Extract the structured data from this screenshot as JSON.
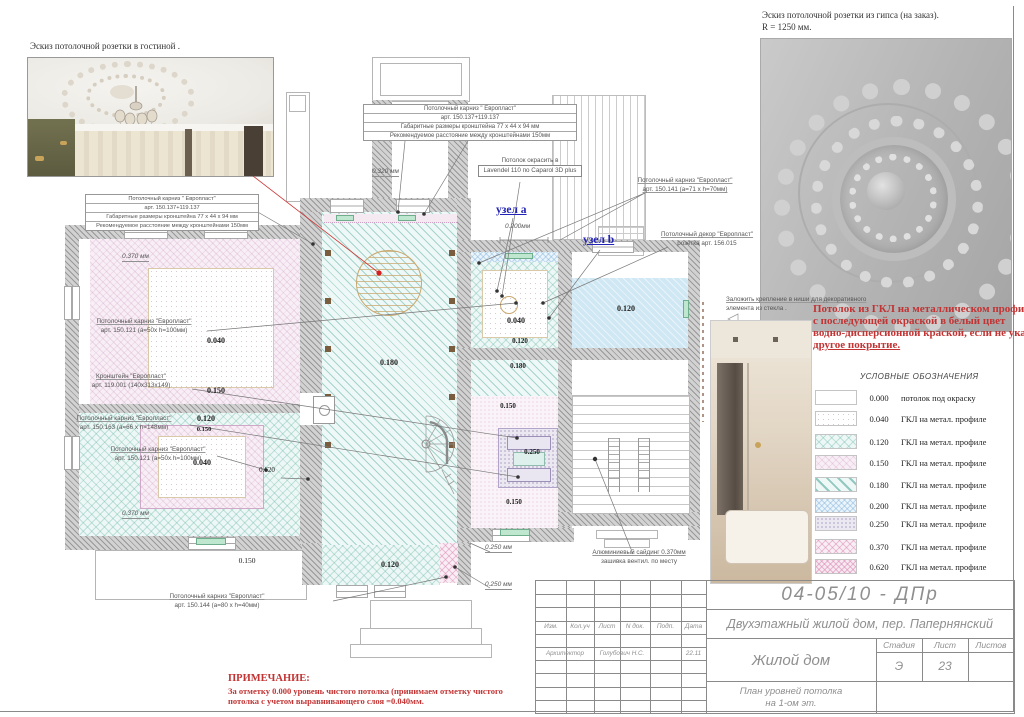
{
  "captions": {
    "living": "Эскиз потолочной розетки в гостиной .",
    "plaster1": "Эскиз потолочной розетки из гипса  (на заказ).",
    "plaster2": "R = 1250 мм."
  },
  "box": {
    "l1": "Потолочный карниз \" Европласт\"",
    "l2": "арт. 150.137+119.137",
    "l3": "Габаритные размеры кронштейна 77 х 44 х 94 мм",
    "l4": "Рекомендуемое расстояние между кронштейнами 150мм"
  },
  "paint": {
    "l1": "Потолок окрасить в",
    "l2": "Lavendel 110 по Caparol 3D plus"
  },
  "co": {
    "c141": {
      "l1": "Потолочный карниз \"Европласт\"",
      "l2": "арт. 150.141 (а=71 х h=70мм)"
    },
    "r156": {
      "l1": "Потолочный декор \"Европласт\"",
      "l2": "розетка арт. 156.015"
    },
    "c121a": {
      "l1": "Потолочный карниз \"Европласт\"",
      "l2": "арт. 150.121 (а=50х h=100мм)"
    },
    "b119": {
      "l1": "Кронштейн \"Европласт\"",
      "l2": "арт. 119.001 (140х313х149)"
    },
    "c163": {
      "l1": "Потолочный карниз \"Европласт\"",
      "l2": "арт. 150.163 (а=66 х h=148мм)"
    },
    "c121b": {
      "l1": "Потолочный карниз \"Европласт\"",
      "l2": "арт. 150.121 (а=50х h=100мм)"
    },
    "c144": {
      "l1": "Потолочный карниз \"Европласт\"",
      "l2": "арт. 150.144 (а=80 х h=40мм)"
    },
    "siding": {
      "l1": "Алюминиевый сайдинг 0.370мм",
      "l2": "зашивка вентил. по месту"
    },
    "glass": {
      "l1": "Заложить крепление в ниши для декоративного",
      "l2": "элемента из стекла ."
    },
    "node_a": "узел a",
    "node_b": "узел b"
  },
  "red": {
    "l1": "Потолок из ГКЛ на металлическом профиле",
    "l2": " с последующей окраской в белый цвет",
    "l3": "водно-дисперсионной краской, если не указано",
    "l4": "другое покрытие."
  },
  "lv": {
    "lt040": "0.040",
    "lt150": "0.150",
    "hall180": "0.180",
    "lb120": "0.120",
    "lb150": "0.150",
    "lb040": "0.040",
    "porch150": "0.150",
    "d620": "0.620",
    "rt040": "0.040",
    "rt120": "0.120",
    "fr120": "0.120",
    "band180": "0.180",
    "rb150a": "0.150",
    "rb250": "0.250",
    "rb150b": "0.150",
    "bc120": "0.120"
  },
  "dm": {
    "d320": "0.320 мм",
    "d200": "0.200мм",
    "d370a": "0.370 мм",
    "d370b": "0.370 мм",
    "d250a": "0.250 мм",
    "d250b": "0.250 мм"
  },
  "legend": {
    "title": "УСЛОВНЫЕ  ОБОЗНАЧЕНИЯ",
    "rows": [
      {
        "value": "0.000",
        "label": "потолок под окраску"
      },
      {
        "value": "0.040",
        "label": "ГКЛ на метал. профиле"
      },
      {
        "value": "0.120",
        "label": "ГКЛ на метал. профиле"
      },
      {
        "value": "0.150",
        "label": "ГКЛ на метал. профиле"
      },
      {
        "value": "0.180",
        "label": "ГКЛ на метал. профиле"
      },
      {
        "value": "0.200",
        "label": "ГКЛ на метал. профиле"
      },
      {
        "value": "0.250",
        "label": "ГКЛ на метал. профиле"
      },
      {
        "value": "0.370",
        "label": "ГКЛ на метал. профиле"
      },
      {
        "value": "0.620",
        "label": "ГКЛ на метал. профиле"
      }
    ]
  },
  "note": {
    "title": "ПРИМЕЧАНИЕ:",
    "l1": "За отметку 0.000 уровень чистого потолка (принимаем отметку  чистого",
    "l2": "потолка с учетом выравнивающего слоя  =0.040мм."
  },
  "tb": {
    "doc": "04-05/10 - ДПр",
    "project": "Двухэтажный жилой дом, пер. Папернянский",
    "object": "Жилой дом",
    "sheet1": "План  уровней потолка",
    "sheet2": "на 1-ом эт.",
    "h_izm": "Изм.",
    "h_koluch": "Кол.уч",
    "h_list": "Лист",
    "h_ndok": "N док.",
    "h_podp": "Подп.",
    "h_data": "Дата",
    "role": "Архитектор",
    "name": "Голубович Н.С.",
    "date": "22.11",
    "h_stage": "Стадия",
    "h_sheet": "Лист",
    "h_sheets": "Листов",
    "stage": "Э",
    "sheet_no": "23",
    "sheets_total": ""
  }
}
